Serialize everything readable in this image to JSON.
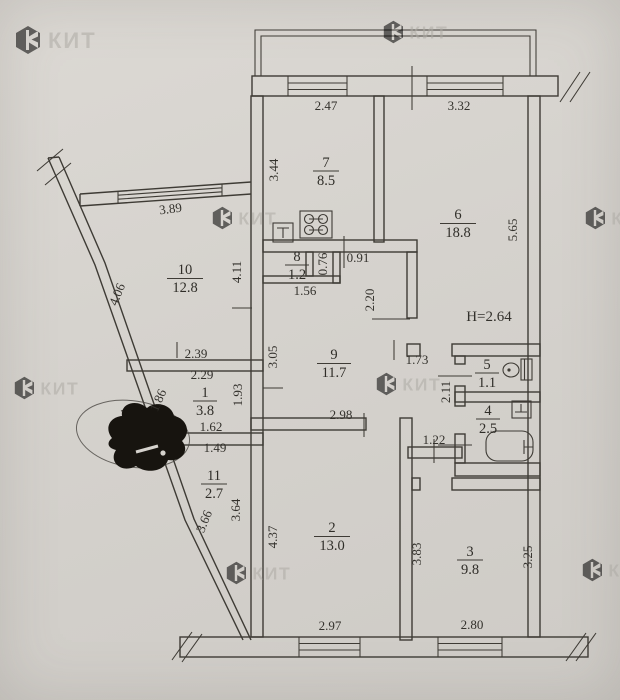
{
  "watermark": {
    "brand": "КИТ"
  },
  "plan": {
    "height_note": "H=2.64",
    "rooms": [
      {
        "num": "7",
        "area": "8.5"
      },
      {
        "num": "6",
        "area": "18.8"
      },
      {
        "num": "10",
        "area": "12.8"
      },
      {
        "num": "8",
        "area": "1.2"
      },
      {
        "num": "9",
        "area": "11.7"
      },
      {
        "num": "5",
        "area": "1.1"
      },
      {
        "num": "4",
        "area": "2.5"
      },
      {
        "num": "1",
        "area": "3.8"
      },
      {
        "num": "11",
        "area": "2.7"
      },
      {
        "num": "2",
        "area": "13.0"
      },
      {
        "num": "3",
        "area": "9.8"
      }
    ],
    "dims": [
      "2.47",
      "3.32",
      "3.44",
      "3.89",
      "4.06",
      "4.11",
      "5.65",
      "0.91",
      "0.76",
      "1.56",
      "2.20",
      "3.05",
      "1.73",
      "2.39",
      "2.29",
      "1.93",
      "1.86",
      "1.62",
      "1.49",
      "2.11",
      "1.22",
      "2.98",
      "3.66",
      "3.64",
      "4.37",
      "3.83",
      "3.25",
      "2.97",
      "2.80"
    ]
  }
}
